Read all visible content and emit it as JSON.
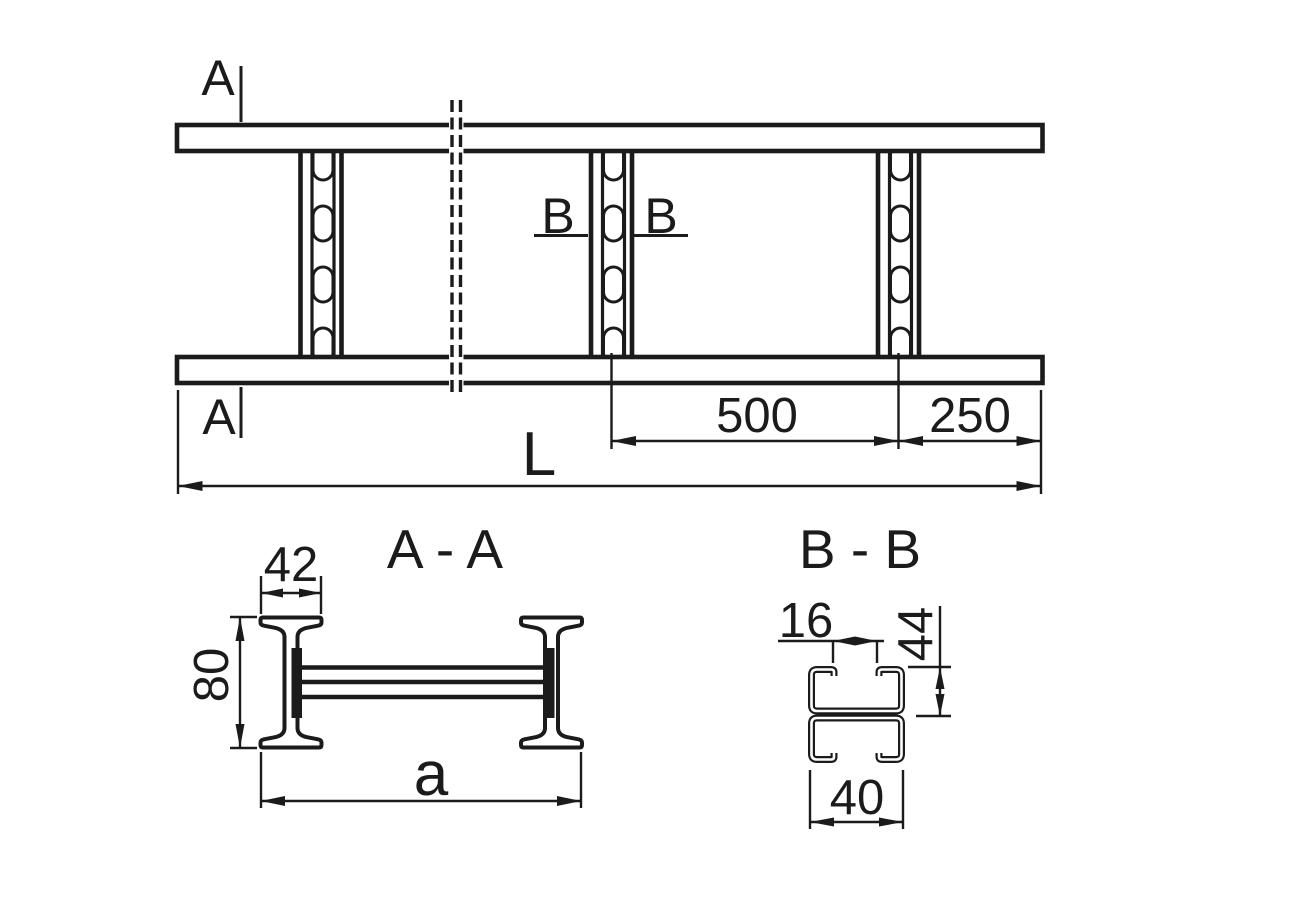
{
  "drawing": {
    "background": "#ffffff",
    "line_color": "#1b1b1b",
    "top_view": {
      "section_a_label": "A",
      "section_b_label": "B",
      "dim_rung_spacing": "500",
      "dim_end_overhang": "250",
      "dim_total_length": "L"
    },
    "section_aa": {
      "title": "A - A",
      "dim_flange_width": "42",
      "dim_rail_height": "80",
      "dim_overall_width": "a"
    },
    "section_bb": {
      "title": "B - B",
      "dim_slot_opening": "16",
      "dim_channel_height": "44",
      "dim_rung_width": "40"
    }
  }
}
